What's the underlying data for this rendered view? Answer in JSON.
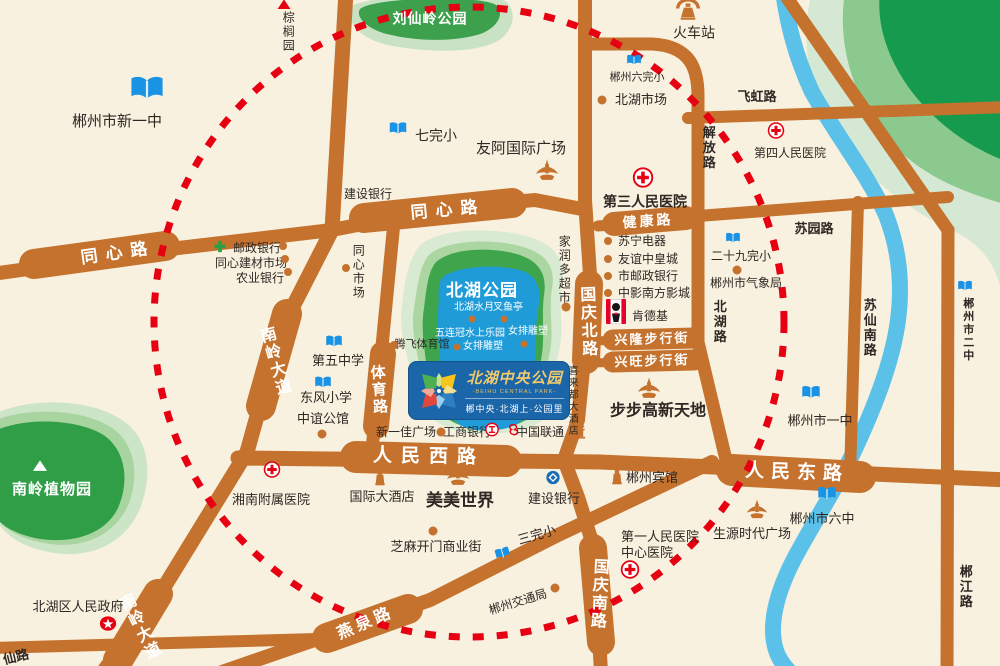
{
  "colors": {
    "bg": "#F8F1DF",
    "road": "#C4722E",
    "river": "#5BC1E8",
    "circle": "#E60012",
    "park_core": "#3FA54C",
    "park_mid": "#ABD6A2",
    "park_outer": "#D8EAD1",
    "lake": "#1F9CD8",
    "school_blue": "#1B93E4",
    "hospital_red": "#E60012",
    "logo_blue": "#1A66A8"
  },
  "logo": {
    "name": "北湖中央公园",
    "en": "-BEIHU CENTRAL PARK-",
    "tagline": "郴中央·北湖上·公园里"
  },
  "road_labels": [
    {
      "text": "同心路",
      "x": 118,
      "y": 253,
      "rot": -8,
      "fs": 17,
      "ls": 8
    },
    {
      "text": "同心路",
      "x": 448,
      "y": 210,
      "rot": -5,
      "fs": 17,
      "ls": 8
    },
    {
      "text": "南岭大道",
      "x": 273,
      "y": 362,
      "rot": -16,
      "fs": 16,
      "vertical": true
    },
    {
      "text": "南岭大道",
      "x": 138,
      "y": 628,
      "rot": -27,
      "fs": 16,
      "vertical": true
    },
    {
      "text": "体育路",
      "x": 378,
      "y": 390,
      "rot": -4,
      "fs": 15,
      "vertical": true
    },
    {
      "text": "人民西路",
      "x": 429,
      "y": 457,
      "rot": 1,
      "fs": 19,
      "ls": 9
    },
    {
      "text": "人民东路",
      "x": 797,
      "y": 473,
      "rot": 2,
      "fs": 19,
      "ls": 7
    },
    {
      "text": "国庆北路",
      "x": 586,
      "y": 322,
      "rot": -2,
      "fs": 16,
      "vertical": true
    },
    {
      "text": "国庆南路",
      "x": 597,
      "y": 594,
      "rot": 3,
      "fs": 16,
      "vertical": true
    },
    {
      "text": "健康路",
      "x": 648,
      "y": 221,
      "rot": -4,
      "fs": 14,
      "ls": 3
    },
    {
      "text": "兴隆步行街",
      "x": 652,
      "y": 339,
      "rot": -2,
      "fs": 13,
      "ls": 2
    },
    {
      "text": "兴旺步行街",
      "x": 652,
      "y": 361,
      "rot": -2,
      "fs": 13,
      "ls": 2
    },
    {
      "text": "燕泉路",
      "x": 366,
      "y": 624,
      "rot": -23,
      "fs": 16,
      "ls": 4
    }
  ],
  "street_labels": [
    {
      "text": "飞虹路",
      "x": 757,
      "y": 97,
      "fs": 13
    },
    {
      "text": "解放路",
      "x": 708,
      "y": 148,
      "fs": 13,
      "vertical": true
    },
    {
      "text": "苏园路",
      "x": 814,
      "y": 229,
      "fs": 13
    },
    {
      "text": "北湖路",
      "x": 719,
      "y": 322,
      "fs": 13,
      "vertical": true
    },
    {
      "text": "苏仙南路",
      "x": 869,
      "y": 328,
      "fs": 13,
      "vertical": true
    },
    {
      "text": "郴州市二中",
      "x": 967,
      "y": 330,
      "fs": 11,
      "vertical": true
    },
    {
      "text": "郴江路",
      "x": 965,
      "y": 587,
      "fs": 13,
      "vertical": true
    },
    {
      "text": "仙路",
      "x": 16,
      "y": 657,
      "fs": 13,
      "rot": -14
    }
  ],
  "park_labels": [
    {
      "text": "刘仙岭公园",
      "x": 430,
      "y": 19,
      "fs": 14
    },
    {
      "text": "北湖公园",
      "x": 482,
      "y": 291,
      "fs": 17
    },
    {
      "text": "南岭植物园",
      "x": 52,
      "y": 490,
      "fs": 15
    }
  ],
  "water_labels": [
    {
      "text": "北湖水月",
      "x": 474,
      "y": 308,
      "fs": 10
    },
    {
      "text": "叉鱼亭",
      "x": 508,
      "y": 308,
      "fs": 10
    },
    {
      "text": "五连冠水上乐园",
      "x": 470,
      "y": 334,
      "fs": 10
    },
    {
      "text": "女排雕塑",
      "x": 528,
      "y": 332,
      "fs": 10
    },
    {
      "text": "女排雕塑",
      "x": 483,
      "y": 347,
      "fs": 10
    }
  ],
  "pois": [
    {
      "text": "郴州市新一中",
      "x": 117,
      "y": 122,
      "fs": 15
    },
    {
      "text": "七完小",
      "x": 436,
      "y": 136,
      "fs": 14
    },
    {
      "text": "友阿国际广场",
      "x": 521,
      "y": 149,
      "fs": 15
    },
    {
      "text": "火车站",
      "x": 694,
      "y": 33,
      "fs": 14
    },
    {
      "text": "棕榈园",
      "x": 288,
      "y": 32,
      "fs": 12,
      "vertical": true
    },
    {
      "text": "郴州六完小",
      "x": 637,
      "y": 78,
      "fs": 11
    },
    {
      "text": "北湖市场",
      "x": 641,
      "y": 100,
      "fs": 13
    },
    {
      "text": "第四人民医院",
      "x": 790,
      "y": 153,
      "fs": 12
    },
    {
      "text": "第三人民医院",
      "x": 645,
      "y": 202,
      "fs": 14,
      "bold": true
    },
    {
      "text": "建设银行",
      "x": 368,
      "y": 194,
      "fs": 12
    },
    {
      "text": "邮政银行",
      "x": 257,
      "y": 248,
      "fs": 12
    },
    {
      "text": "同心建材市场",
      "x": 251,
      "y": 263,
      "fs": 12
    },
    {
      "text": "农业银行",
      "x": 260,
      "y": 278,
      "fs": 12
    },
    {
      "text": "同心市场",
      "x": 358,
      "y": 272,
      "fs": 12,
      "vertical": true
    },
    {
      "text": "家润多超市",
      "x": 564,
      "y": 270,
      "fs": 12,
      "vertical": true
    },
    {
      "text": "苏宁电器",
      "x": 642,
      "y": 241,
      "fs": 12
    },
    {
      "text": "友谊中皇城",
      "x": 648,
      "y": 259,
      "fs": 12
    },
    {
      "text": "市邮政银行",
      "x": 648,
      "y": 276,
      "fs": 12
    },
    {
      "text": "中影南方影城",
      "x": 654,
      "y": 293,
      "fs": 12
    },
    {
      "text": "肯德基",
      "x": 650,
      "y": 316,
      "fs": 12
    },
    {
      "text": "二十九完小",
      "x": 741,
      "y": 256,
      "fs": 12
    },
    {
      "text": "郴州市气象局",
      "x": 746,
      "y": 283,
      "fs": 12
    },
    {
      "text": "第五中学",
      "x": 338,
      "y": 361,
      "fs": 13
    },
    {
      "text": "东风小学",
      "x": 326,
      "y": 398,
      "fs": 13
    },
    {
      "text": "中谊公馆",
      "x": 323,
      "y": 419,
      "fs": 13
    },
    {
      "text": "腾飞体育馆",
      "x": 422,
      "y": 345,
      "fs": 11
    },
    {
      "text": "喜来都大酒店",
      "x": 571,
      "y": 401,
      "fs": 10,
      "vertical": true
    },
    {
      "text": "步步高新天地",
      "x": 658,
      "y": 412,
      "fs": 16,
      "bold": true
    },
    {
      "text": "新一佳广场",
      "x": 406,
      "y": 432,
      "fs": 12
    },
    {
      "text": "工商银行",
      "x": 467,
      "y": 432,
      "fs": 12
    },
    {
      "text": "中国联通",
      "x": 540,
      "y": 432,
      "fs": 12
    },
    {
      "text": "国际大酒店",
      "x": 382,
      "y": 497,
      "fs": 13
    },
    {
      "text": "美美世界",
      "x": 460,
      "y": 501,
      "fs": 17,
      "bold": true
    },
    {
      "text": "建设银行",
      "x": 554,
      "y": 499,
      "fs": 13
    },
    {
      "text": "湘南附属医院",
      "x": 271,
      "y": 500,
      "fs": 13
    },
    {
      "text": "芝麻开门商业街",
      "x": 436,
      "y": 547,
      "fs": 13
    },
    {
      "text": "三完小",
      "x": 537,
      "y": 535,
      "fs": 13,
      "rot": -16
    },
    {
      "text": "郴州交通局",
      "x": 518,
      "y": 602,
      "fs": 12,
      "rot": -17
    },
    {
      "text": "北湖区人民政府",
      "x": 78,
      "y": 607,
      "fs": 13
    },
    {
      "text": "郴州宾馆",
      "x": 652,
      "y": 478,
      "fs": 13
    },
    {
      "text": "第一人民医院",
      "x": 660,
      "y": 537,
      "fs": 13
    },
    {
      "text": "中心医院",
      "x": 647,
      "y": 553,
      "fs": 13
    },
    {
      "text": "生源时代广场",
      "x": 752,
      "y": 534,
      "fs": 13
    },
    {
      "text": "郴州市六中",
      "x": 822,
      "y": 519,
      "fs": 13
    },
    {
      "text": "郴州市一中",
      "x": 820,
      "y": 421,
      "fs": 13
    }
  ],
  "markers": [
    {
      "type": "school-icon",
      "x": 147,
      "y": 91,
      "sz": 34
    },
    {
      "type": "school-icon",
      "x": 398,
      "y": 131,
      "sz": 18
    },
    {
      "type": "school-icon",
      "x": 634,
      "y": 62,
      "sz": 15
    },
    {
      "type": "school-icon",
      "x": 733,
      "y": 240,
      "sz": 15
    },
    {
      "type": "school-icon",
      "x": 334,
      "y": 344,
      "sz": 17
    },
    {
      "type": "school-icon",
      "x": 323,
      "y": 385,
      "sz": 17
    },
    {
      "type": "school-icon",
      "x": 503,
      "y": 555,
      "sz": 15,
      "rot": -16
    },
    {
      "type": "school-icon",
      "x": 827,
      "y": 496,
      "sz": 19
    },
    {
      "type": "school-icon",
      "x": 811,
      "y": 395,
      "sz": 19
    },
    {
      "type": "school-icon",
      "x": 965,
      "y": 288,
      "sz": 15
    },
    {
      "type": "hospital-icon",
      "x": 643,
      "y": 180,
      "sz": 21
    },
    {
      "type": "hospital-icon",
      "x": 776,
      "y": 133,
      "sz": 17
    },
    {
      "type": "hospital-icon",
      "x": 272,
      "y": 472,
      "sz": 17
    },
    {
      "type": "hospital-icon",
      "x": 630,
      "y": 572,
      "sz": 19
    },
    {
      "type": "train-icon",
      "x": 688,
      "y": 11,
      "sz": 27
    },
    {
      "type": "tri-red-icon",
      "x": 284,
      "y": 5,
      "sz": 13
    },
    {
      "type": "tri-white-icon",
      "x": 40,
      "y": 467,
      "sz": 14
    },
    {
      "type": "star-icon",
      "x": 108,
      "y": 626,
      "sz": 17
    },
    {
      "type": "post-icon",
      "x": 220,
      "y": 249,
      "sz": 13
    },
    {
      "type": "kfc-icon",
      "x": 616,
      "y": 314,
      "sz": 20
    },
    {
      "type": "icbc-icon",
      "x": 492,
      "y": 432,
      "sz": 14
    },
    {
      "type": "unicom-icon",
      "x": 513,
      "y": 432,
      "sz": 13
    },
    {
      "type": "ccb-icon",
      "x": 553,
      "y": 480,
      "sz": 14
    },
    {
      "type": "tower-icon",
      "x": 547,
      "y": 173,
      "sz": 24
    },
    {
      "type": "tower-icon",
      "x": 458,
      "y": 478,
      "sz": 24
    },
    {
      "type": "tower-icon",
      "x": 649,
      "y": 391,
      "sz": 24
    },
    {
      "type": "tower-icon",
      "x": 757,
      "y": 512,
      "sz": 22
    },
    {
      "type": "hotel-icon",
      "x": 380,
      "y": 478,
      "sz": 20
    },
    {
      "type": "hotel-icon",
      "x": 617,
      "y": 477,
      "sz": 20
    },
    {
      "type": "pagoda-icon",
      "x": 581,
      "y": 433,
      "sz": 16
    },
    {
      "type": "dot",
      "x": 283,
      "y": 246,
      "sz": 8
    },
    {
      "type": "dot",
      "x": 285,
      "y": 259,
      "sz": 8
    },
    {
      "type": "dot",
      "x": 288,
      "y": 272,
      "sz": 8
    },
    {
      "type": "dot",
      "x": 346,
      "y": 268,
      "sz": 8
    },
    {
      "type": "dot",
      "x": 602,
      "y": 100,
      "sz": 9
    },
    {
      "type": "dot",
      "x": 608,
      "y": 241,
      "sz": 8
    },
    {
      "type": "dot",
      "x": 608,
      "y": 259,
      "sz": 8
    },
    {
      "type": "dot",
      "x": 608,
      "y": 276,
      "sz": 8
    },
    {
      "type": "dot",
      "x": 608,
      "y": 293,
      "sz": 8
    },
    {
      "type": "dot",
      "x": 737,
      "y": 270,
      "sz": 9
    },
    {
      "type": "dot",
      "x": 566,
      "y": 307,
      "sz": 9
    },
    {
      "type": "dot",
      "x": 394,
      "y": 345,
      "sz": 8
    },
    {
      "type": "dot",
      "x": 322,
      "y": 434,
      "sz": 9
    },
    {
      "type": "dot",
      "x": 441,
      "y": 432,
      "sz": 9
    },
    {
      "type": "dot",
      "x": 433,
      "y": 531,
      "sz": 9
    },
    {
      "type": "dot",
      "x": 555,
      "y": 588,
      "sz": 9
    },
    {
      "type": "dot",
      "x": 472,
      "y": 319,
      "sz": 7
    },
    {
      "type": "dot",
      "x": 504,
      "y": 319,
      "sz": 7
    },
    {
      "type": "dot",
      "x": 524,
      "y": 344,
      "sz": 7
    },
    {
      "type": "dot",
      "x": 457,
      "y": 347,
      "sz": 7
    }
  ]
}
